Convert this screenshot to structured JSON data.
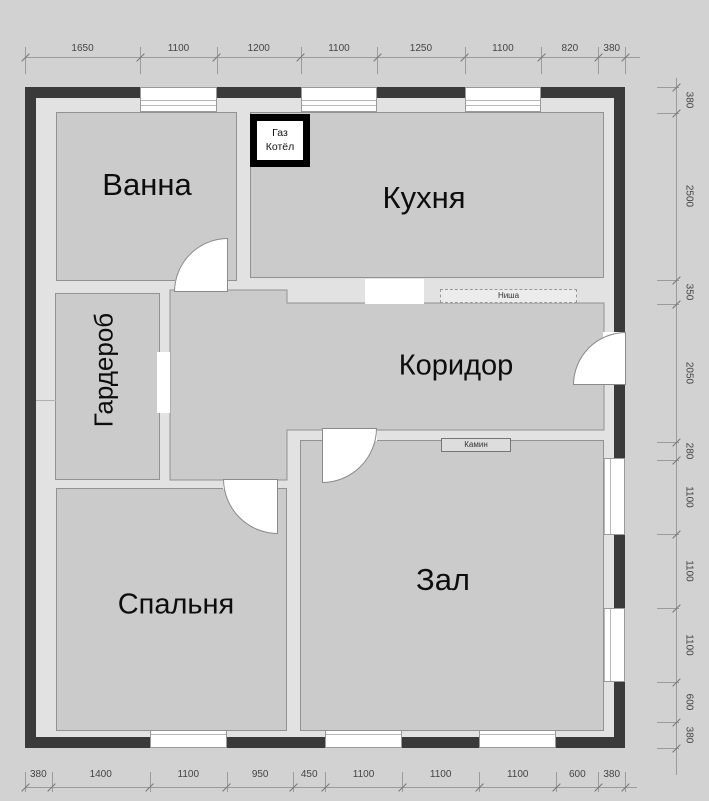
{
  "plan_title": "floor-plan",
  "rooms": {
    "bath": {
      "label": "Ванна"
    },
    "kitchen": {
      "label": "Кухня"
    },
    "wardrobe": {
      "label": "Гардероб"
    },
    "corridor": {
      "label": "Коридор"
    },
    "bedroom": {
      "label": "Спальня"
    },
    "hall": {
      "label": "Зал"
    }
  },
  "fixtures": {
    "boiler_line1": "Газ",
    "boiler_line2": "Котёл",
    "niche": "Ниша",
    "fireplace": "Камин"
  },
  "dimensions": {
    "top": [
      1650,
      1100,
      1200,
      1100,
      1250,
      1100,
      820,
      380
    ],
    "bottom": [
      380,
      1400,
      1100,
      950,
      450,
      1100,
      1100,
      1100,
      600,
      380
    ],
    "right": [
      380,
      2500,
      350,
      2050,
      280,
      1100,
      1100,
      1100,
      600,
      380
    ]
  },
  "colors": {
    "exterior_wall": "#3a3a3a",
    "interior_floor": "#e2e2e2",
    "room_floor": "#cbcbcb",
    "background": "#d2d2d2",
    "opening": "#ffffff"
  }
}
